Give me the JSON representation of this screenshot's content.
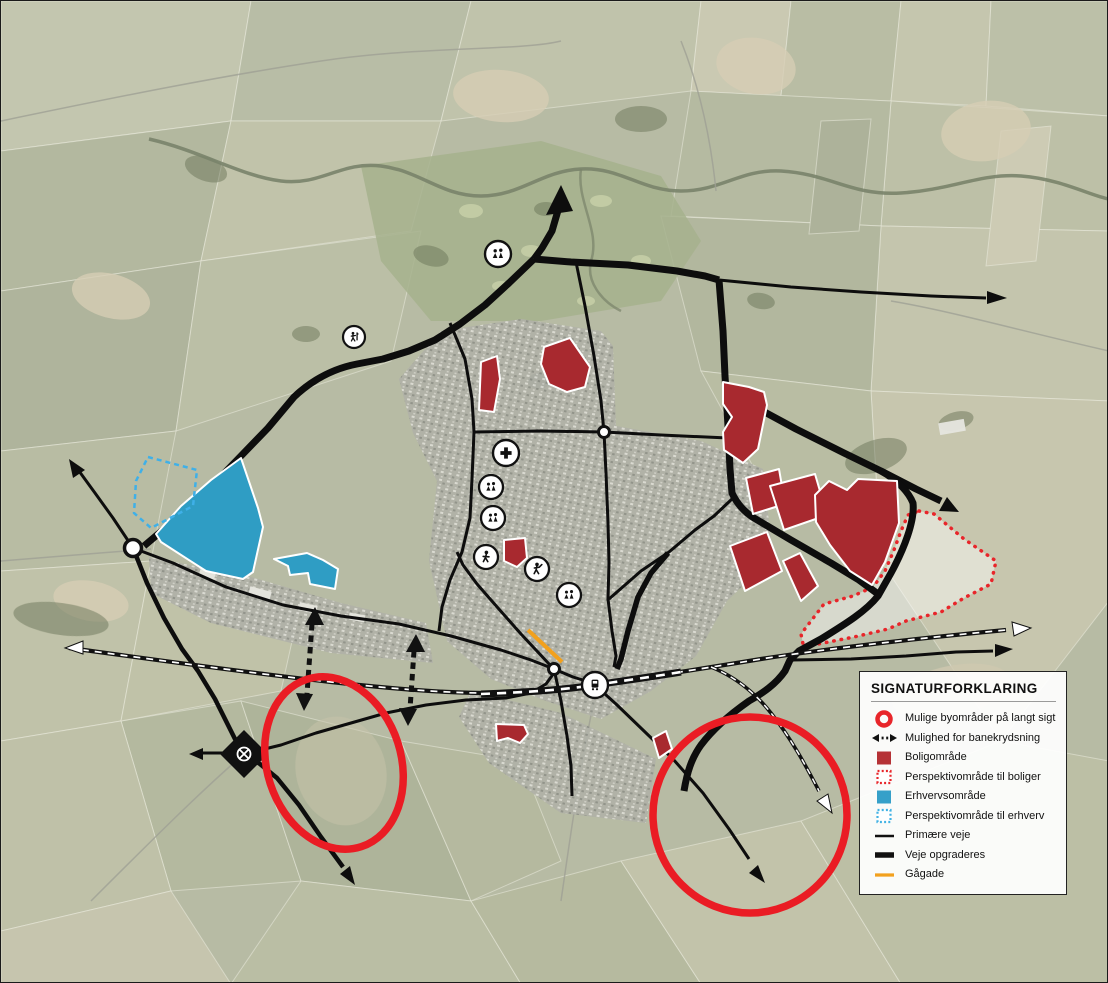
{
  "legend": {
    "title": "SIGNATURFORKLARING",
    "items": [
      {
        "id": "long-term-urban-areas",
        "label": "Mulige byområder på langt sigt"
      },
      {
        "id": "rail-crossing-option",
        "label": "Mulighed for banekrydsning"
      },
      {
        "id": "residential-area",
        "label": "Boligområde"
      },
      {
        "id": "residential-perspective-area",
        "label": "Perspektivområde til boliger"
      },
      {
        "id": "business-area",
        "label": "Erhvervsområde"
      },
      {
        "id": "business-perspective-area",
        "label": "Perspektivområde til erhverv"
      },
      {
        "id": "primary-roads",
        "label": "Primære veje"
      },
      {
        "id": "roads-to-upgrade",
        "label": "Veje opgraderes"
      },
      {
        "id": "pedestrian-street",
        "label": "Gågade"
      }
    ]
  },
  "colors": {
    "residential_fill": "#a8292f",
    "residential_perspective_border": "#e8252a",
    "business_fill": "#2f9dc4",
    "business_perspective_border": "#3fb0e8",
    "ring_red": "#ea1c24",
    "road_black": "#0d0d0d",
    "pedestrian_orange": "#f2a11e"
  },
  "poi_icons": [
    {
      "name": "people-icon",
      "x": 497,
      "y": 253
    },
    {
      "name": "golfer-icon",
      "x": 353,
      "y": 336
    },
    {
      "name": "medical-cross-icon",
      "x": 505,
      "y": 452
    },
    {
      "name": "people-icon",
      "x": 490,
      "y": 486
    },
    {
      "name": "people-icon",
      "x": 492,
      "y": 517
    },
    {
      "name": "pedestrian-icon",
      "x": 485,
      "y": 556
    },
    {
      "name": "sports-icon",
      "x": 536,
      "y": 568
    },
    {
      "name": "people-icon",
      "x": 568,
      "y": 594
    },
    {
      "name": "train-station-icon",
      "x": 594,
      "y": 684
    }
  ]
}
